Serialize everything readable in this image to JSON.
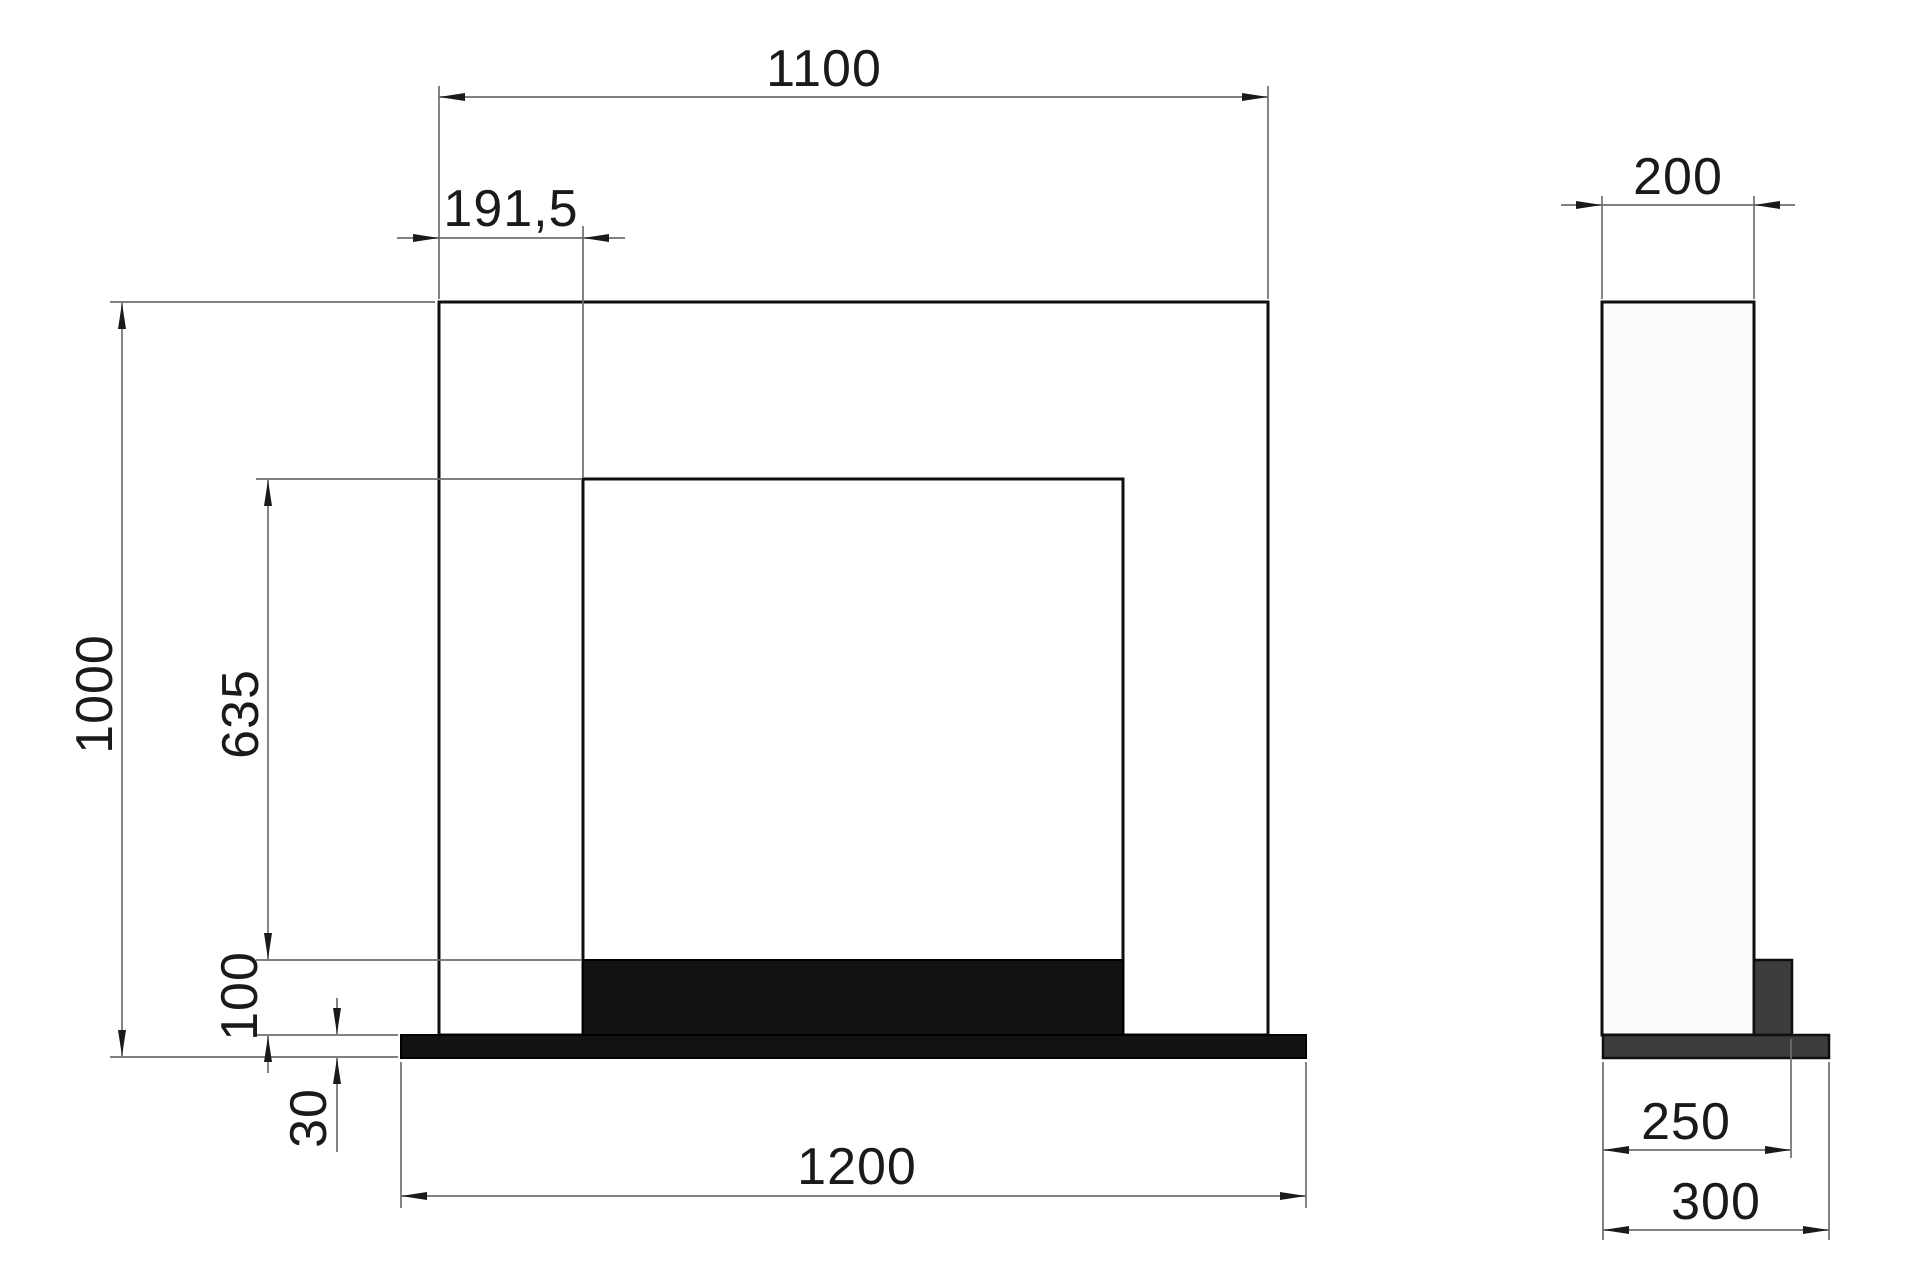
{
  "drawing": {
    "title": "fireplace-surround-dimension-drawing",
    "views": {
      "front_view": "front elevation",
      "side_view": "side elevation"
    },
    "dimensions": {
      "top_width": "1100",
      "leg_width": "191,5",
      "total_height": "1000",
      "opening_height": "635",
      "hearth_thickness": "100",
      "base_plate_thickness": "30",
      "base_plate_width": "1200",
      "body_depth": "200",
      "hearth_depth": "250",
      "base_plate_depth": "300"
    },
    "colors": {
      "surround_fill": "#ececec",
      "front_dark_fill": "#121212",
      "side_dark_fill": "#3d3d3d",
      "body_fill": "#fcfcfc",
      "outline": "#0f0f0f",
      "dim_line": "#6e6e6e",
      "ink": "#1a1a1a",
      "background": "#ffffff"
    }
  }
}
